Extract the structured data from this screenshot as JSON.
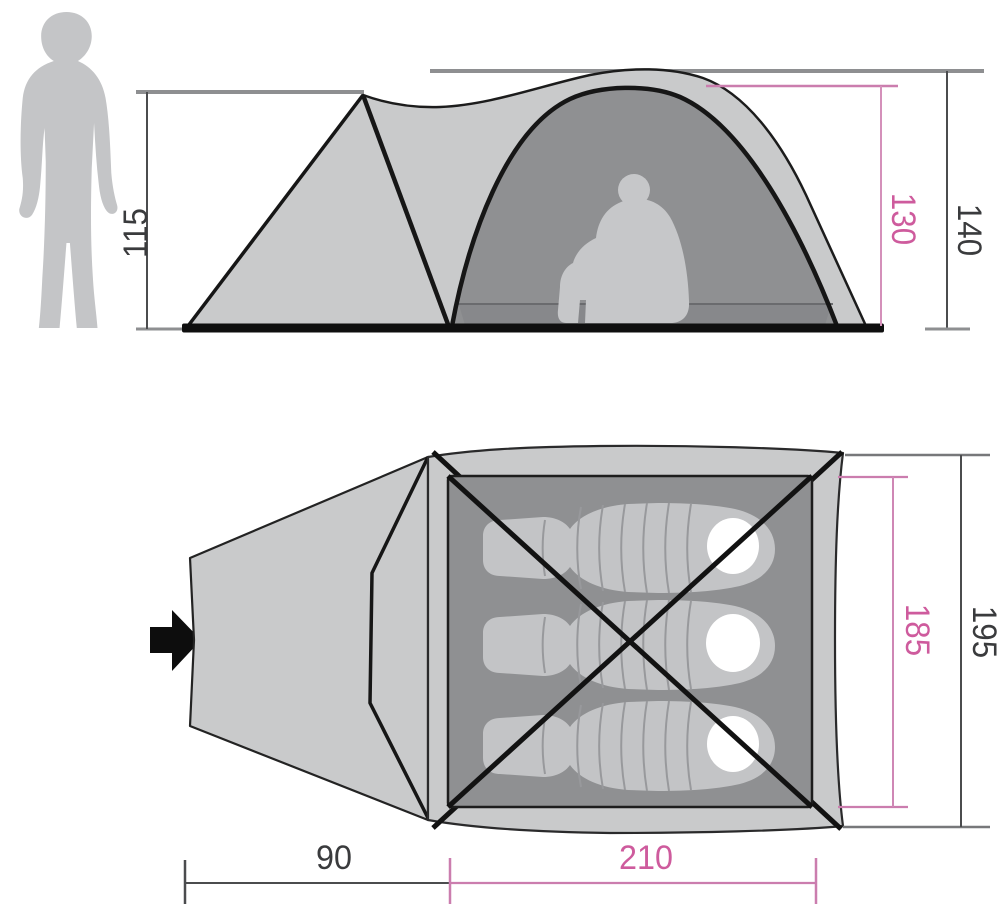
{
  "diagram": {
    "type": "tent-dimension-drawing",
    "views": {
      "side_view": "side elevation with seated person",
      "top_view": "floor plan with three sleeping bags",
      "scale_figure": "standing person silhouette"
    },
    "dimensions": {
      "vestibule_height": "115",
      "inner_peak_height": "130",
      "outer_peak_height": "140",
      "inner_width": "185",
      "outer_width": "195",
      "vestibule_depth": "90",
      "inner_length": "210"
    },
    "colors": {
      "dimension_pink_text": "#ce5b9d",
      "dimension_pink_line": "#cb7dae",
      "dimension_dark_text": "#3a3b3d",
      "dimension_dark_line": "#4b4c4e",
      "extension_gray_line": "#8e8f91",
      "tent_fabric": "#c9cacb",
      "tent_interior": "#8f9092",
      "silhouette_gray": "#c4c5c7",
      "outline_black": "#161616",
      "pillow_white": "#ffffff"
    },
    "icons": {
      "entrance_arrow": "black arrow pointing right into vestibule"
    }
  }
}
